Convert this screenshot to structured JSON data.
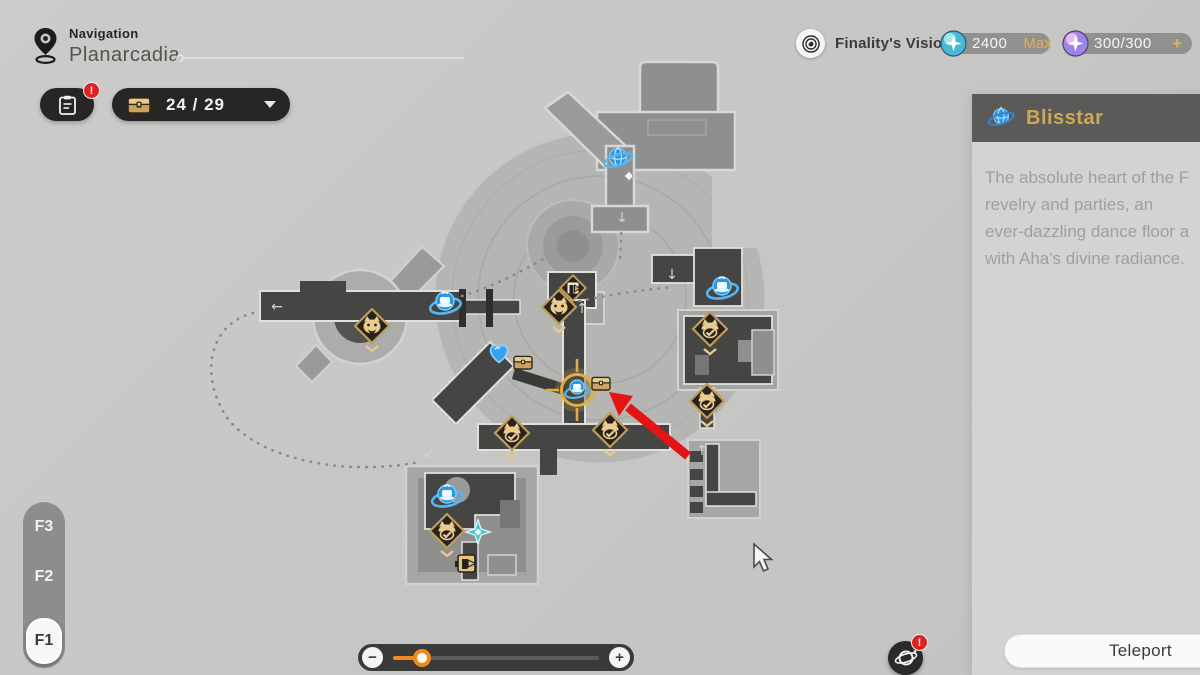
{
  "header": {
    "nav_label": "Navigation",
    "location_name": "Planarcadia",
    "journal_badge": "!",
    "chest_count": "24 / 29",
    "vision_label": "Finality's Vision",
    "currency_teal": {
      "value": "2400",
      "max_label": "Max"
    },
    "currency_purple": {
      "value": "300/300",
      "plus_label": "+"
    }
  },
  "floor_selector": {
    "floors": [
      "F3",
      "F2",
      "F1"
    ],
    "selected": "F1"
  },
  "panel": {
    "title": "Blisstar",
    "description_lines": [
      "The absolute heart of the F",
      "revelry and parties, an",
      "ever-dazzling dance floor a",
      "with Aha's divine radiance."
    ]
  },
  "footer": {
    "teleport_label": "Teleport",
    "planet_badge": "!",
    "zoom_minus": "−",
    "zoom_plus": "+",
    "zoom_value_pct": 14
  },
  "colors": {
    "accent_gold": "#d9a93e",
    "alert_red": "#e32020",
    "slider_orange": "#ef8a1c",
    "anchor_blue": "#2a97e0",
    "pill_dark": "#262624"
  },
  "map": {
    "markers": [
      {
        "type": "blisstar",
        "x": 618,
        "y": 159
      },
      {
        "type": "white-diamond",
        "x": 629,
        "y": 176
      },
      {
        "type": "anchor",
        "x": 445,
        "y": 304
      },
      {
        "type": "anchor",
        "x": 722,
        "y": 289
      },
      {
        "type": "anchor",
        "x": 447,
        "y": 497
      },
      {
        "type": "heart",
        "x": 499,
        "y": 353
      },
      {
        "type": "chest",
        "x": 523,
        "y": 362
      },
      {
        "type": "door-diamond",
        "x": 573,
        "y": 288
      },
      {
        "type": "monster",
        "x": 559,
        "y": 312
      },
      {
        "type": "monster",
        "x": 372,
        "y": 331
      },
      {
        "type": "monster-check",
        "x": 710,
        "y": 334
      },
      {
        "type": "monster-check",
        "x": 707,
        "y": 406
      },
      {
        "type": "monster-check",
        "x": 512,
        "y": 438
      },
      {
        "type": "monster-check",
        "x": 610,
        "y": 435
      },
      {
        "type": "monster-check",
        "x": 447,
        "y": 536
      },
      {
        "type": "sparkle",
        "x": 478,
        "y": 532
      },
      {
        "type": "door",
        "x": 468,
        "y": 564
      },
      {
        "type": "selected-anchor",
        "x": 577,
        "y": 390
      },
      {
        "type": "chest",
        "x": 601,
        "y": 383
      }
    ],
    "nav_arrows": [
      {
        "char": "←",
        "x": 277,
        "y": 311
      },
      {
        "char": "↙",
        "x": 429,
        "y": 458
      },
      {
        "char": "↑",
        "x": 582,
        "y": 313
      },
      {
        "char": "↓",
        "x": 622,
        "y": 222
      },
      {
        "char": "↓",
        "x": 672,
        "y": 279
      },
      {
        "char": "↑",
        "x": 702,
        "y": 455
      }
    ]
  }
}
